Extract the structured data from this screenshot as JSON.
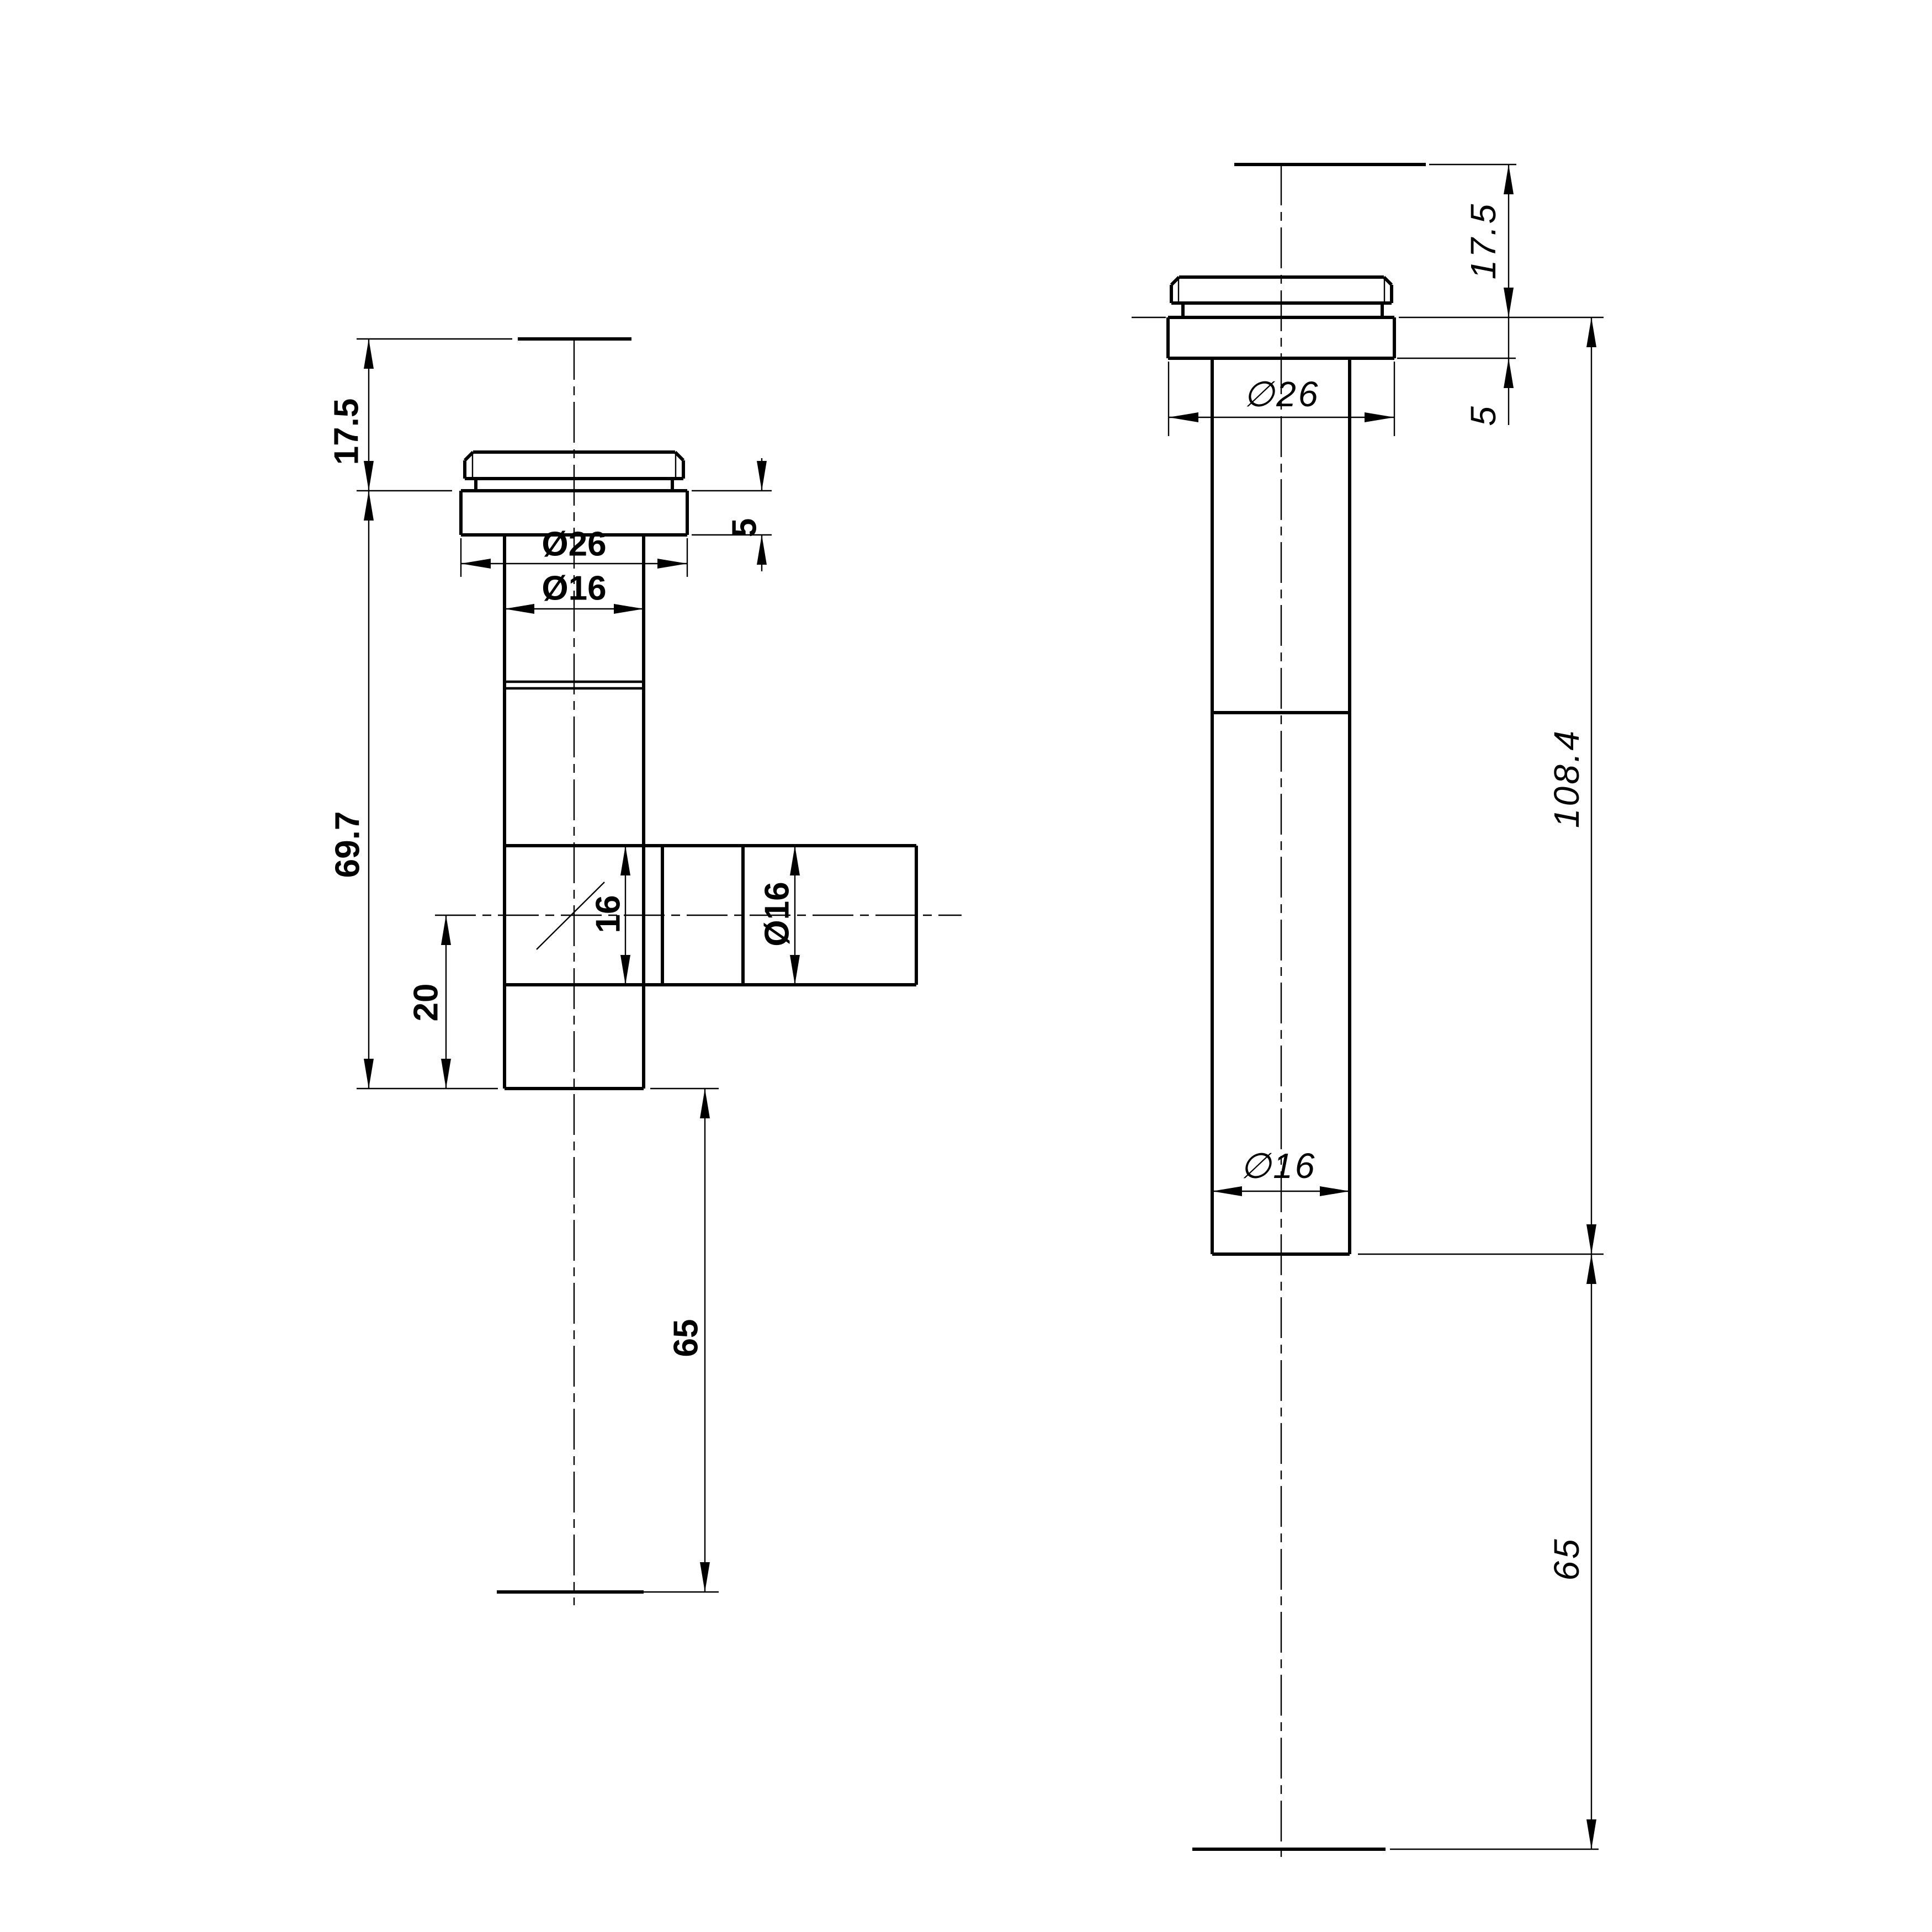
{
  "drawing": {
    "background": "#ffffff",
    "line_color": "#000000",
    "left_view": {
      "name": "tee fitting side view",
      "dims": {
        "cap_height": "17.5",
        "flange_height": "5",
        "flange_diameter": "Ø26",
        "pipe_diameter": "Ø16",
        "body_length": "69.7",
        "branch_bore": "16",
        "branch_diameter": "Ø16",
        "branch_offset": "20",
        "tail_length": "65"
      }
    },
    "right_view": {
      "name": "straight fitting front view",
      "dims": {
        "cap_height": "17.5",
        "flange_height": "5",
        "flange_diameter": "∅26",
        "body_length": "108.4",
        "pipe_diameter": "∅16",
        "tail_length": "65"
      }
    }
  }
}
